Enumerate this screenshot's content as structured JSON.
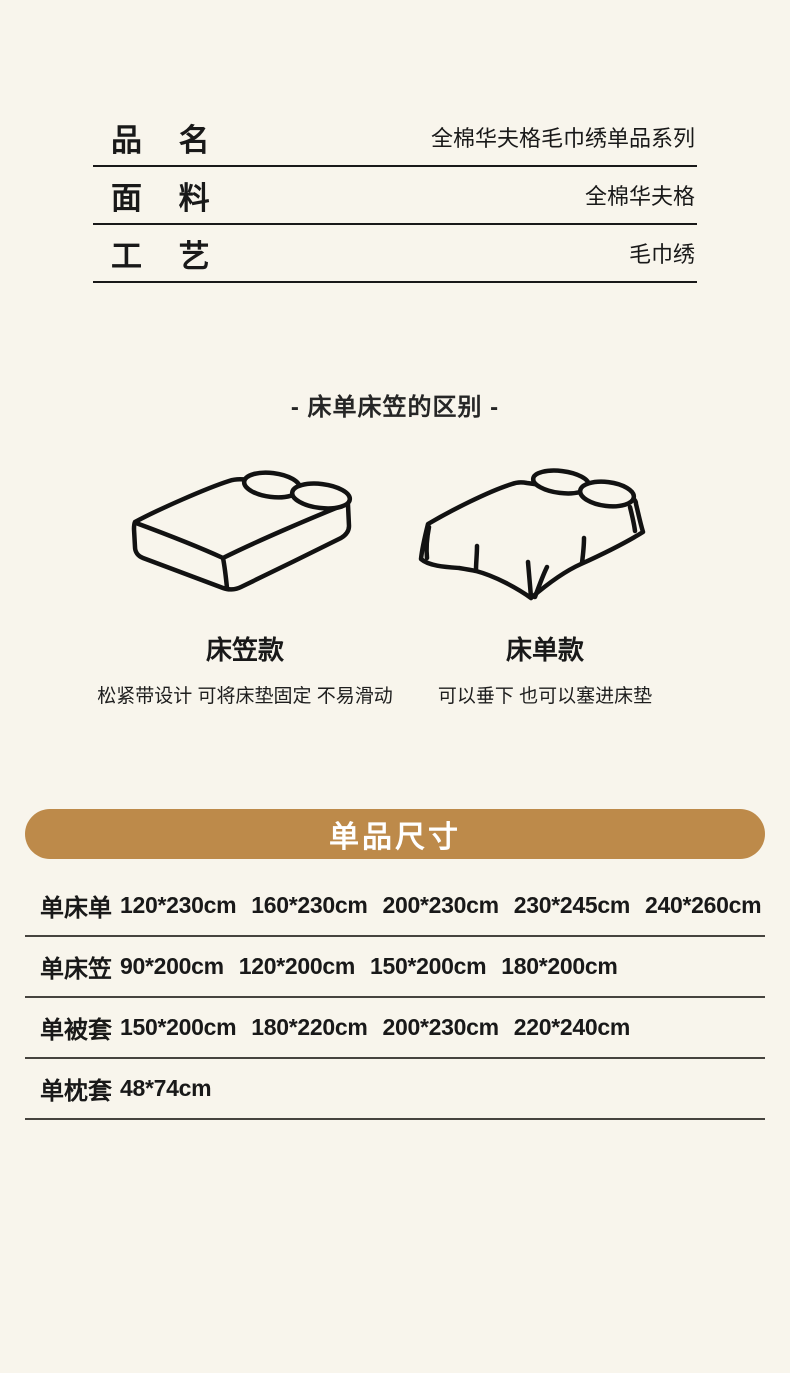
{
  "page": {
    "background": "#f8f5ec",
    "text_color": "#191919"
  },
  "spec_table": {
    "rows": [
      {
        "label": "品 名",
        "value": "全棉华夫格毛巾绣单品系列"
      },
      {
        "label": "面 料",
        "value": "全棉华夫格"
      },
      {
        "label": "工 艺",
        "value": "毛巾绣"
      }
    ]
  },
  "diff_section": {
    "title": "- 床单床笠的区别 -",
    "items": [
      {
        "name": "床笠款",
        "desc": "松紧带设计 可将床垫固定 不易滑动",
        "illustration": "fitted-sheet-bed"
      },
      {
        "name": "床单款",
        "desc": "可以垂下 也可以塞进床垫",
        "illustration": "flat-sheet-bed"
      }
    ]
  },
  "size_section": {
    "title": "单品尺寸",
    "accent_color": "#bd8a4a",
    "rows": [
      {
        "label": "单床单",
        "sizes": [
          "120*230cm",
          "160*230cm",
          "200*230cm",
          "230*245cm",
          "240*260cm"
        ]
      },
      {
        "label": "单床笠",
        "sizes": [
          "90*200cm",
          "120*200cm",
          "150*200cm",
          "180*200cm"
        ]
      },
      {
        "label": "单被套",
        "sizes": [
          "150*200cm",
          "180*220cm",
          "200*230cm",
          "220*240cm"
        ]
      },
      {
        "label": "单枕套",
        "sizes": [
          "48*74cm"
        ]
      }
    ]
  }
}
